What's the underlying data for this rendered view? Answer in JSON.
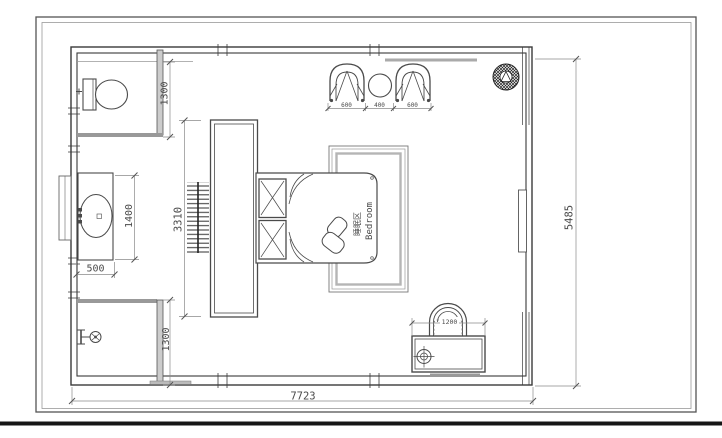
{
  "drawing": {
    "type": "bedroom-floor-plan",
    "zone": {
      "label_cn": "睡眠区",
      "label_en": "Bedroom"
    },
    "dimensions": {
      "bathroom_depth": "1300",
      "shower_depth": "1300",
      "vanity_length": "1400",
      "vanity_width": "500",
      "wardrobe_length": "3310",
      "armchair_left": "600",
      "side_table": "400",
      "armchair_right": "600",
      "desk_width": "1200",
      "room_depth": "5485",
      "room_width": "7723"
    },
    "colors": {
      "line": "#3a3a3a",
      "dim_line": "#8a8a8a",
      "thick_gray": "#999999"
    }
  }
}
